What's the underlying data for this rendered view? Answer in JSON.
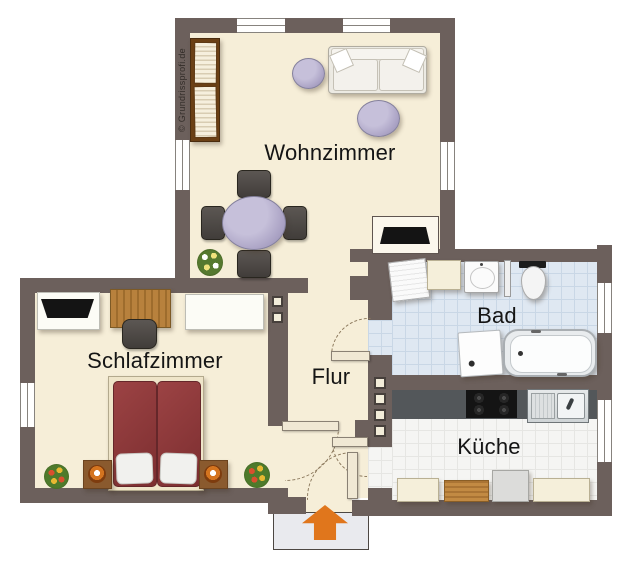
{
  "watermark": "© Grundrissprofi.de",
  "rooms": {
    "wohnzimmer": {
      "label": "Wohnzimmer"
    },
    "schlafzimmer": {
      "label": "Schlafzimmer"
    },
    "flur": {
      "label": "Flur"
    },
    "bad": {
      "label": "Bad"
    },
    "kueche": {
      "label": "Küche"
    }
  },
  "colors": {
    "wall": "#6c605c",
    "floor": "#f6eed8",
    "bad_tile": "#dfe8f2",
    "kitchen_tile": "#f5f5f3",
    "arrow": "#e0761c",
    "bed": "#8e383b",
    "table": "#b3abcf",
    "counter": "#53575a"
  },
  "legend": {
    "entrance_arrow": "up-arrow",
    "door_symbol": "quarter-arc-dashed",
    "window_symbol": "triple-line-white"
  }
}
